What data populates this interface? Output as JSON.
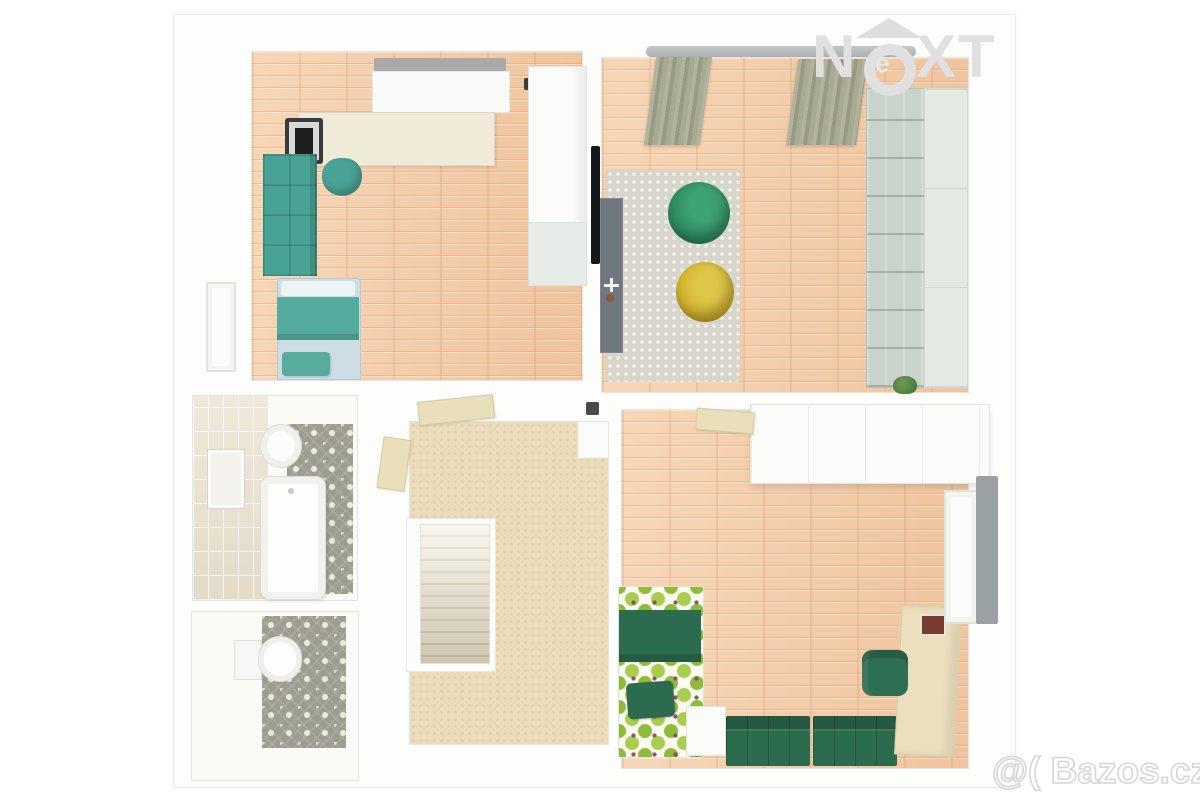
{
  "watermarks": {
    "brand_logo": {
      "left": "N",
      "center": "e",
      "right": "XT"
    },
    "site": "@( Bazos.cz"
  },
  "palette": {
    "wall_white": "#fdfdfc",
    "parquet_wood": "#f4cdab",
    "teal_furniture": "#49a296",
    "bedding_blue": "#ccdde6",
    "olive_curtain": "#a4a58f",
    "beanbag_green": "#2f8e63",
    "beanbag_yellow": "#d2b42e",
    "rug_gray": "#d8d5cb",
    "tv_cabinet_gray": "#70777e",
    "shelf_unit_gray_green": "#cdd6cf",
    "bathroom_tile_wall": "#e9e2d2",
    "ornament_tile_floor": "#9c9c91",
    "hallway_carpet": "#ebdcba",
    "stair_wood": "#e5dcc2",
    "kiwi_bedding_green": "#9ec43f",
    "dark_green_sofa": "#2d6b4f",
    "desk_beige": "#ebdfbe",
    "watermark_gray": "#dedede"
  },
  "floor_plan": {
    "view": "3d-top-down-render",
    "rooms": [
      {
        "name": "children-bedroom",
        "floor": "wood-parquet",
        "furniture": [
          "window-radiator",
          "desk",
          "computer",
          "desk-chair",
          "teal-cube-shelf",
          "single-bed-teal-blue",
          "white-wardrobe",
          "door-frame-left"
        ]
      },
      {
        "name": "living-room",
        "floor": "wood-parquet",
        "furniture": [
          "curtain-rail",
          "curtain-left",
          "curtain-right",
          "gray-rug",
          "bean-bag-green",
          "bean-bag-yellow",
          "wall-tv",
          "tv-cabinet",
          "toy-airplane",
          "shelving-wall-unit",
          "plant"
        ]
      },
      {
        "name": "bathroom",
        "floor": "ornament-tile",
        "furniture": [
          "tiled-wall",
          "mirror",
          "round-sink",
          "bathtub"
        ]
      },
      {
        "name": "toilet-room",
        "floor": "ornament-tile",
        "furniture": [
          "toilet"
        ]
      },
      {
        "name": "hallway",
        "floor": "beige-carpet",
        "furniture": [
          "staircase",
          "open-door-top",
          "open-door-left",
          "dark-box"
        ]
      },
      {
        "name": "master-bedroom",
        "floor": "wood-parquet",
        "furniture": [
          "white-wardrobe-run",
          "open-door-beige",
          "double-bed-kiwi-pattern",
          "dark-green-blanket",
          "dark-green-pillow",
          "nightstand",
          "bench-sofa-dark-green",
          "desk-beige",
          "desk-picture",
          "desk-chair-green",
          "white-door-right",
          "gray-mirror-panel"
        ]
      }
    ]
  }
}
